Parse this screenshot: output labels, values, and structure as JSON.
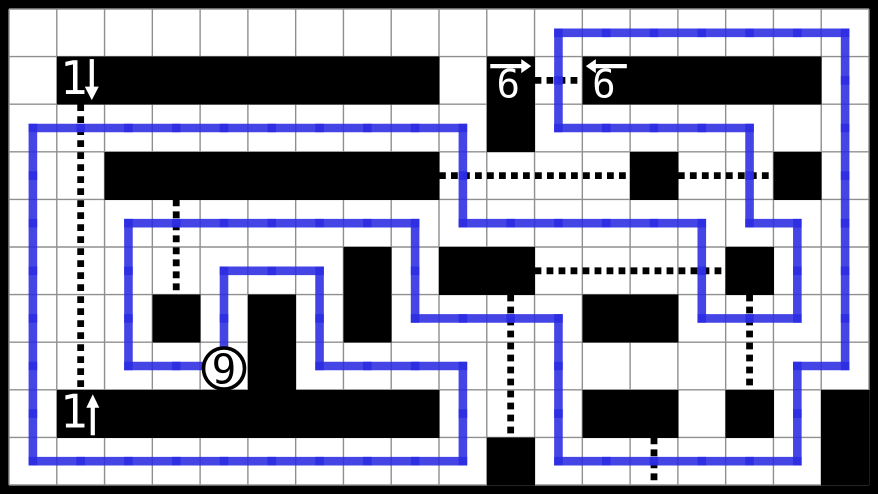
{
  "board": {
    "cols": 18,
    "rows": 10,
    "width": 878,
    "height": 494,
    "frame_thickness": 9,
    "colors": {
      "background": "#ffffff",
      "frame": "#000000",
      "grid_line": "#8f8f8f",
      "shaded_cell": "#000000",
      "loop_line": "#2b2be2",
      "pencil_mark": "#000000",
      "clue_text": "#ffffff",
      "circle_fill": "#ffffff",
      "circle_ring": "#000000",
      "circle_text": "#000000"
    },
    "shaded_cells": [
      [
        1,
        1
      ],
      [
        2,
        1
      ],
      [
        3,
        1
      ],
      [
        4,
        1
      ],
      [
        5,
        1
      ],
      [
        6,
        1
      ],
      [
        7,
        1
      ],
      [
        8,
        1
      ],
      [
        10,
        1
      ],
      [
        12,
        1
      ],
      [
        13,
        1
      ],
      [
        14,
        1
      ],
      [
        15,
        1
      ],
      [
        16,
        1
      ],
      [
        10,
        2
      ],
      [
        2,
        3
      ],
      [
        3,
        3
      ],
      [
        4,
        3
      ],
      [
        5,
        3
      ],
      [
        6,
        3
      ],
      [
        7,
        3
      ],
      [
        8,
        3
      ],
      [
        13,
        3
      ],
      [
        16,
        3
      ],
      [
        7,
        5
      ],
      [
        9,
        5
      ],
      [
        10,
        5
      ],
      [
        15,
        5
      ],
      [
        3,
        6
      ],
      [
        5,
        6
      ],
      [
        7,
        6
      ],
      [
        12,
        6
      ],
      [
        13,
        6
      ],
      [
        5,
        7
      ],
      [
        1,
        8
      ],
      [
        2,
        8
      ],
      [
        3,
        8
      ],
      [
        4,
        8
      ],
      [
        5,
        8
      ],
      [
        6,
        8
      ],
      [
        7,
        8
      ],
      [
        8,
        8
      ],
      [
        12,
        8
      ],
      [
        13,
        8
      ],
      [
        15,
        8
      ],
      [
        17,
        8
      ],
      [
        10,
        9
      ],
      [
        17,
        9
      ]
    ],
    "arrow_clues": [
      {
        "col": 1,
        "row": 1,
        "number": "1",
        "direction": "down",
        "arrow_position": "right-of-number"
      },
      {
        "col": 10,
        "row": 1,
        "number": "6",
        "direction": "right",
        "arrow_position": "above-number"
      },
      {
        "col": 12,
        "row": 1,
        "number": "6",
        "direction": "left",
        "arrow_position": "above-number"
      },
      {
        "col": 1,
        "row": 8,
        "number": "1",
        "direction": "up",
        "arrow_position": "right-of-number"
      }
    ],
    "circle_clue": {
      "col": 4,
      "row": 7,
      "number": "9"
    },
    "loop_vertices": [
      [
        0,
        2
      ],
      [
        9,
        2
      ],
      [
        9,
        4
      ],
      [
        14,
        4
      ],
      [
        14,
        6
      ],
      [
        16,
        6
      ],
      [
        16,
        4
      ],
      [
        15,
        4
      ],
      [
        15,
        2
      ],
      [
        11,
        2
      ],
      [
        11,
        0
      ],
      [
        17,
        0
      ],
      [
        17,
        7
      ],
      [
        16,
        7
      ],
      [
        16,
        9
      ],
      [
        11,
        9
      ],
      [
        11,
        6
      ],
      [
        8,
        6
      ],
      [
        8,
        4
      ],
      [
        2,
        4
      ],
      [
        2,
        7
      ],
      [
        4,
        7
      ],
      [
        4,
        5
      ],
      [
        6,
        5
      ],
      [
        6,
        7
      ],
      [
        9,
        7
      ],
      [
        9,
        9
      ],
      [
        0,
        9
      ]
    ],
    "pencil_marks": [
      {
        "orient": "v",
        "col": 1,
        "from": 2,
        "to": 8
      },
      {
        "orient": "v",
        "col": 3,
        "from": 4,
        "to": 6
      },
      {
        "orient": "h",
        "row": 1,
        "from": 11,
        "to": 12
      },
      {
        "orient": "h",
        "row": 3,
        "from": 9,
        "to": 13
      },
      {
        "orient": "h",
        "row": 3,
        "from": 14,
        "to": 16
      },
      {
        "orient": "h",
        "row": 5,
        "from": 11,
        "to": 15
      },
      {
        "orient": "v",
        "col": 10,
        "from": 6,
        "to": 9
      },
      {
        "orient": "v",
        "col": 15,
        "from": 6,
        "to": 8
      },
      {
        "orient": "v",
        "col": 13,
        "from": 9,
        "to": 10
      }
    ]
  }
}
